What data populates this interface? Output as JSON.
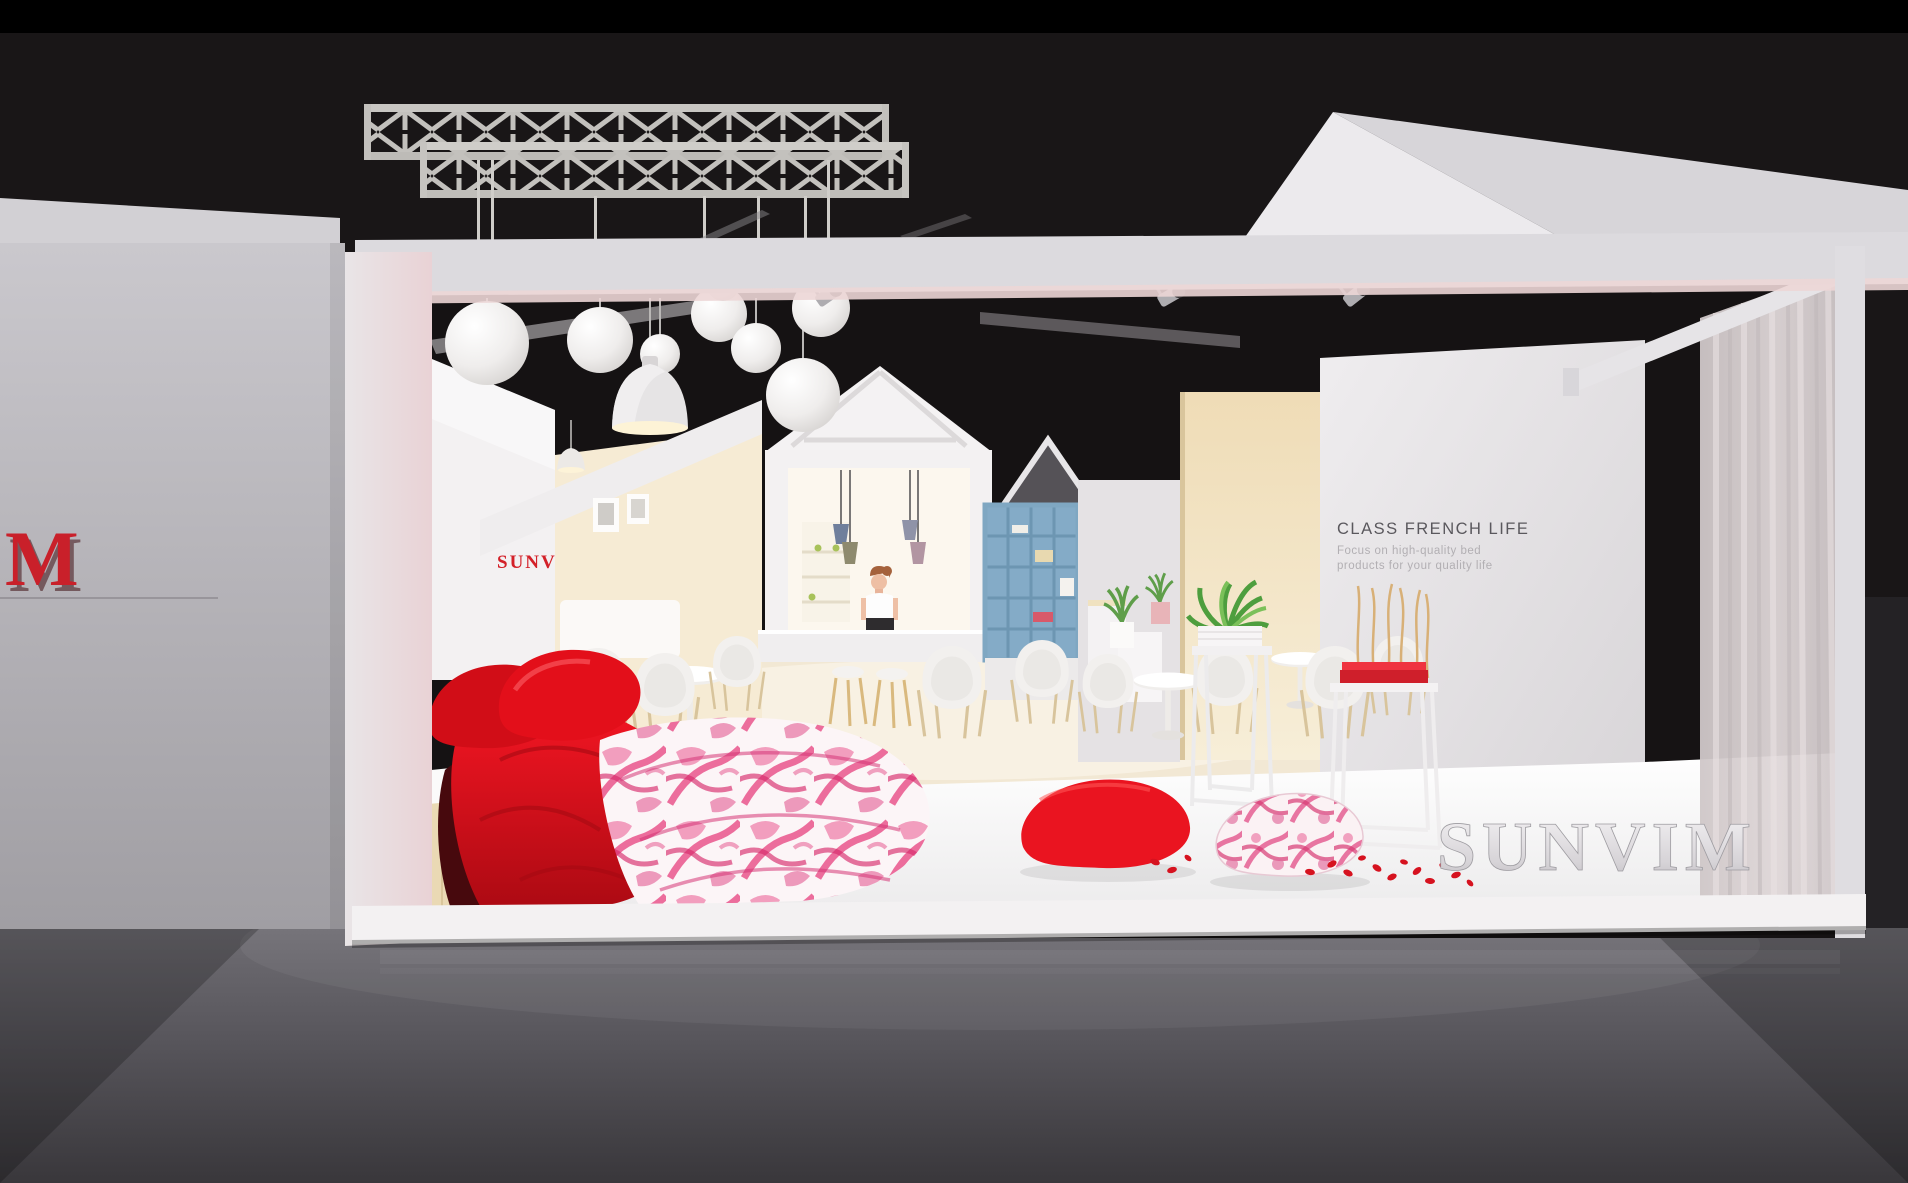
{
  "branding": {
    "left_wall_letter": "M",
    "panel_logo": "SUNV",
    "floor_logo_3d": "SUNVIM"
  },
  "right_wall": {
    "heading": "CLASS FRENCH LIFE",
    "subtitle_line1": "Focus on high-quality bed",
    "subtitle_line2": "products for your quality life"
  },
  "colors": {
    "brand_red": "#d42127",
    "pillow_red": "#e8131c",
    "floral_pink": "#e0437f",
    "background_dark": "#191617",
    "booth_white": "#e9e7ea",
    "warm_beige": "#f4e4c6",
    "shelf_blue": "#84abc7",
    "foreground_floor_grey": "#5c5a5f"
  }
}
